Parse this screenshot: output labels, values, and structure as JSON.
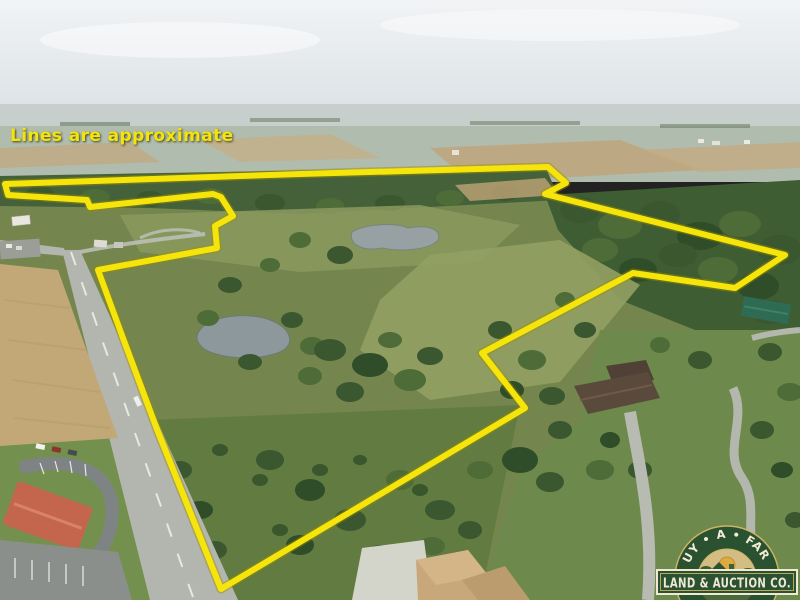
{
  "annotation": {
    "note": "Lines are approximate"
  },
  "logo": {
    "arc_text": "BUY • A • FARM",
    "banner_text": "LAND & AUCTION CO."
  },
  "boundary": {
    "points": [
      [
        5,
        184
      ],
      [
        300,
        174
      ],
      [
        548,
        167
      ],
      [
        566,
        183
      ],
      [
        545,
        194
      ],
      [
        785,
        255
      ],
      [
        735,
        288
      ],
      [
        633,
        273
      ],
      [
        482,
        353
      ],
      [
        525,
        408
      ],
      [
        221,
        589
      ],
      [
        158,
        432
      ],
      [
        120,
        330
      ],
      [
        98,
        270
      ],
      [
        190,
        253
      ],
      [
        217,
        248
      ],
      [
        215,
        226
      ],
      [
        233,
        216
      ],
      [
        221,
        197
      ],
      [
        213,
        194
      ],
      [
        90,
        207
      ],
      [
        87,
        200
      ],
      [
        8,
        195
      ]
    ],
    "points_svg": "5,184 300,174 548,167 566,183 545,194 785,255 735,288 633,273 482,353 525,408 221,589 158,432 120,330 98,270 190,253 217,248 215,226 233,216 221,197 213,194 90,207 87,200 8,195"
  },
  "colors": {
    "boundary_yellow": "#f6e50a",
    "annotation_yellow": "#f3e50c",
    "logo_green": "#2a5130",
    "logo_gold": "#cab466",
    "logo_cream": "#efe9d2"
  }
}
